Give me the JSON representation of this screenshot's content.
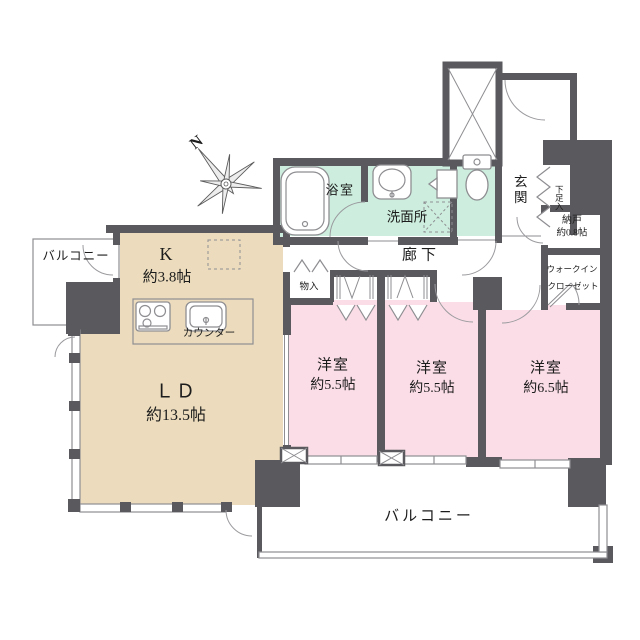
{
  "floorplan": {
    "compass_label": "N",
    "labels": {
      "balcony_left": "バルコニー",
      "balcony_bottom": "バルコニー",
      "kitchen_name": "K",
      "kitchen_size": "約3.8帖",
      "counter": "カウンター",
      "ld_name": "ＬＤ",
      "ld_size": "約13.5帖",
      "bath": "浴室",
      "washroom": "洗面所",
      "corridor": "廊下",
      "entrance": "玄関",
      "shoe_box": "下足入",
      "storage_name": "納戸",
      "storage_size": "約0.8帖",
      "wic_line1": "ウォークイン",
      "wic_line2": "クローゼット",
      "closet_small": "物入",
      "bedroom1_name": "洋室",
      "bedroom1_size": "約5.5帖",
      "bedroom2_name": "洋室",
      "bedroom2_size": "約5.5帖",
      "bedroom3_name": "洋室",
      "bedroom3_size": "約6.5帖"
    },
    "colors": {
      "wall": "#5a5a5e",
      "ldk_floor": "#ecdcbd",
      "bedroom_floor": "#fadde6",
      "wet_area_floor": "#cdeede",
      "line": "#8e8e92",
      "text": "#1c1c1c"
    }
  }
}
